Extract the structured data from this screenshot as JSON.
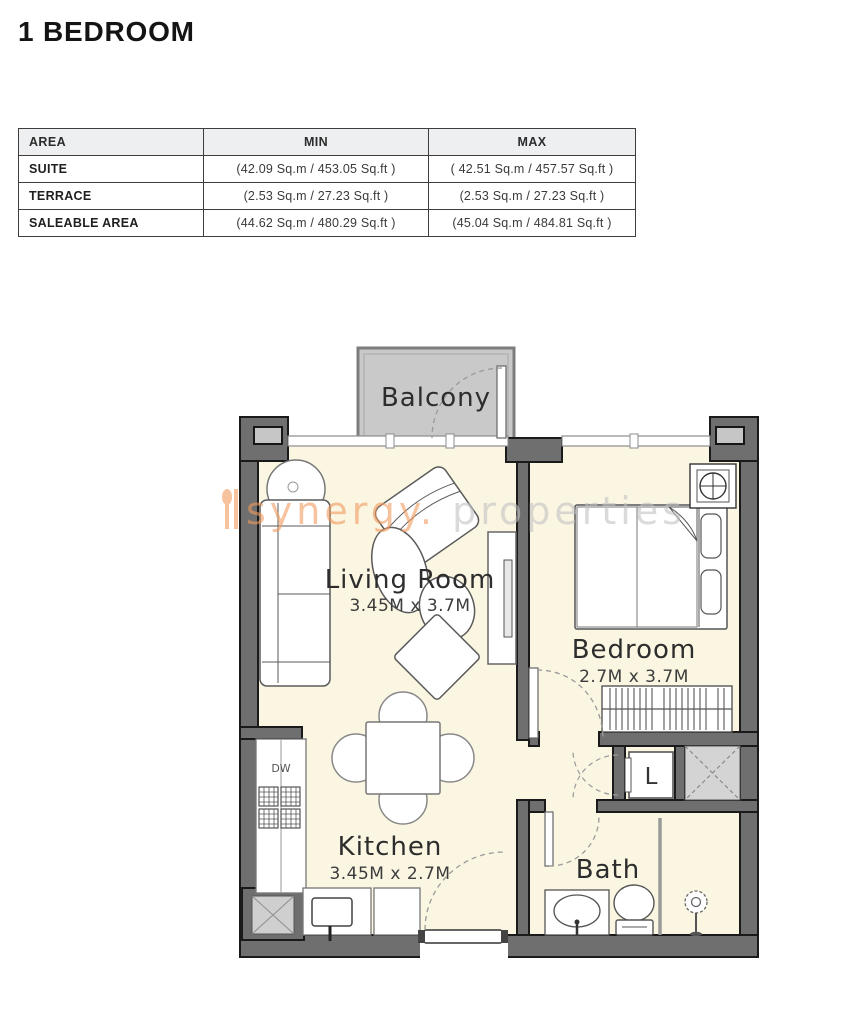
{
  "page": {
    "title": "1 BEDROOM"
  },
  "area_table": {
    "headers": [
      "AREA",
      "MIN",
      "MAX"
    ],
    "rows": [
      {
        "area": "SUITE",
        "min": "(42.09 Sq.m / 453.05 Sq.ft )",
        "max": "( 42.51 Sq.m / 457.57 Sq.ft )"
      },
      {
        "area": "TERRACE",
        "min": "(2.53 Sq.m / 27.23 Sq.ft )",
        "max": "(2.53 Sq.m / 27.23 Sq.ft )"
      },
      {
        "area": "SALEABLE AREA",
        "min": "(44.62 Sq.m / 480.29 Sq.ft )",
        "max": "(45.04 Sq.m / 484.81 Sq.ft )"
      }
    ]
  },
  "floorplan": {
    "balcony_label": "Balcony",
    "living_room": {
      "name": "Living Room",
      "dims": "3.45M x 3.7M"
    },
    "bedroom": {
      "name": "Bedroom",
      "dims": "2.7M x 3.7M"
    },
    "kitchen": {
      "name": "Kitchen",
      "dims": "3.45M x 2.7M"
    },
    "bath_label": "Bath",
    "dishwasher_label": "DW",
    "laundry_label": "L"
  },
  "watermark": {
    "part1": "synergy.",
    "part2": " properties"
  },
  "colors": {
    "wall": "#6f6f6f",
    "wall_outline": "#1a1a1a",
    "floor": "#faf6e2",
    "balcony": "#c9c9c9",
    "watermark_orange": "#f29a5e",
    "watermark_gray": "#c2c2c2",
    "table_header_bg": "#edeff1"
  }
}
